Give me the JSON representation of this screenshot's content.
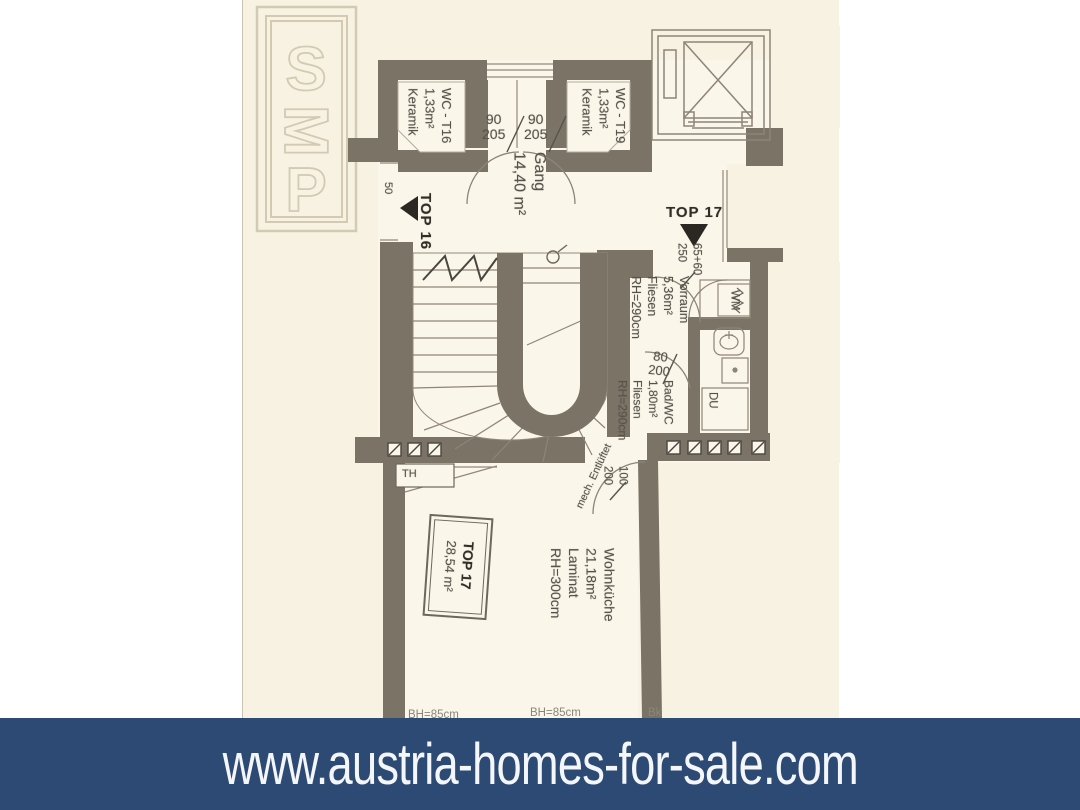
{
  "watermark": {
    "letters": [
      "S",
      "M",
      "P"
    ]
  },
  "banner": {
    "url": "www.austria-homes-for-sale.com",
    "bg_color": "#2d4a75",
    "text_color": "#f4f6fa"
  },
  "colors": {
    "wall": "#7b7365",
    "paper": "#f8f2e2",
    "floor": "#faf6e9",
    "thin_line": "#92897b",
    "label_text": "#57534b"
  },
  "plan": {
    "units": {
      "top16": {
        "label": "TOP 16"
      },
      "top17": {
        "label": "TOP 17"
      }
    },
    "rooms": {
      "wc_t16": [
        "WC - T16",
        "1,33m²",
        "Keramik"
      ],
      "wc_t19": [
        "WC - T19",
        "1,33m²",
        "Keramik"
      ],
      "gang": [
        "Gang",
        "14,40 m²"
      ],
      "vorraum": [
        "Vorraum",
        "5,36m²",
        "Fliesen",
        "RH=290cm"
      ],
      "bad": [
        "Bad/WC",
        "1,80m²",
        "Fliesen",
        "RH=290cm"
      ],
      "wohnkueche": [
        "Wohnküche",
        "21,18m²",
        "Laminat",
        "RH=300cm"
      ],
      "top17_box": [
        "TOP 17",
        "28,54 m²"
      ]
    },
    "doors": {
      "wc_left_w": "90",
      "wc_left_h": "205",
      "wc_right_w": "90",
      "wc_right_h": "205",
      "top17_w": "65+60",
      "top17_h": "250",
      "bad_w": "80",
      "bad_h": "200",
      "wohn_w": "100",
      "wohn_h": "200",
      "top16_dim": "50"
    },
    "fixtures": {
      "wm": "WM",
      "du": "DU",
      "th": "TH"
    },
    "notes": {
      "vent": "mech. Entlüftet",
      "bh1": "BH=85cm",
      "bh2": "BH=85cm",
      "bk": "Bk"
    }
  }
}
